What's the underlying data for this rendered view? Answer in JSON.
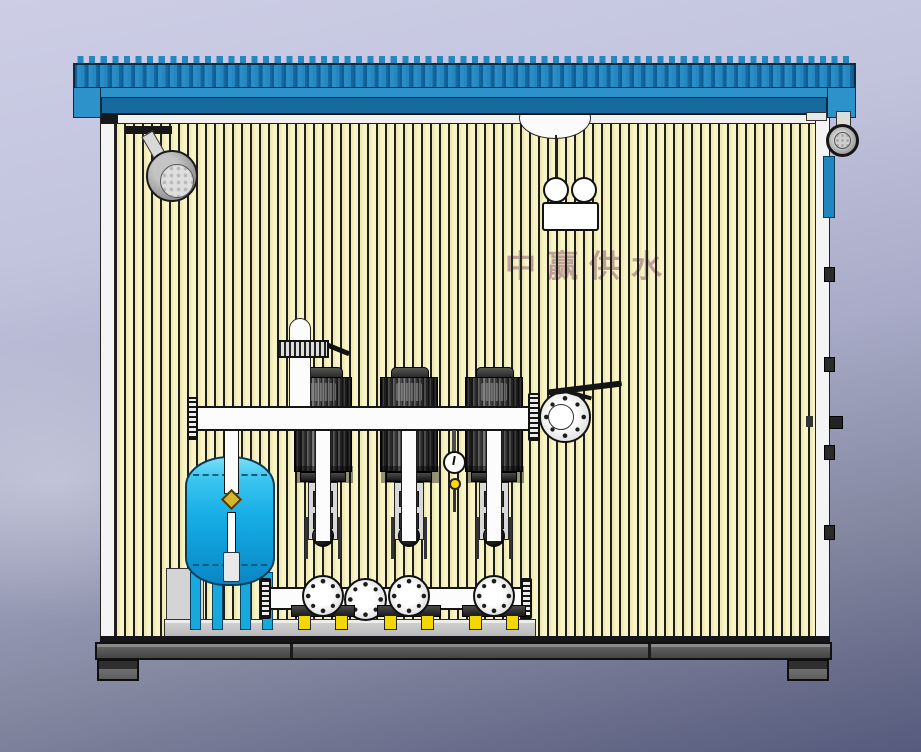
{
  "watermark": {
    "text": "中赢供水"
  },
  "equipment": {
    "pump_count": 3,
    "components": [
      "corrugated-roof",
      "ceiling-spotlight",
      "hanging-twin-lamp",
      "ceiling-dome-vent",
      "air-release-riser",
      "discharge-manifold",
      "butterfly-valve-with-lever",
      "pressure-gauge",
      "vertical-multistage-pump",
      "diaphragm-pressure-tank",
      "tank-feed-pipe-with-brass-valve",
      "suction-manifold",
      "blind-flange",
      "equipment-skid",
      "base-frame",
      "support-foot",
      "exterior-wall-lamp",
      "exterior-louver-panel",
      "door-hinge",
      "door-handle"
    ]
  },
  "colors": {
    "bg_top": "#cdcde6",
    "bg_mid": "#a9acc8",
    "bg_bottom": "#565a7c",
    "roof_rib": "#2487c0",
    "roof_rib_dark": "#0e5e96",
    "roof_fascia": "#2e92ca",
    "roof_eave": "#176a9e",
    "roof_outline": "#0b2b40",
    "wall_cream": "#f8f4c8",
    "wall_cream_dark": "#efe9b2",
    "wall_line": "#1e1e1e",
    "trim_white": "#f4f4f4",
    "pipe_white": "#fcfcfc",
    "motor_dark": "#2e2e2e",
    "tank_top": "#7adef8",
    "tank_mid": "#18aee6",
    "tank_bottom": "#0a86c2",
    "tank_leg": "#17a9dd",
    "damper_yellow": "#f2d800",
    "brass": "#d9b42a",
    "skid_gray": "#cfcfcf",
    "frame_gray": "#606060",
    "foot_gray": "#707070",
    "panel_blue": "#1f86bf",
    "watermark_pink": "#9a6d7a"
  }
}
